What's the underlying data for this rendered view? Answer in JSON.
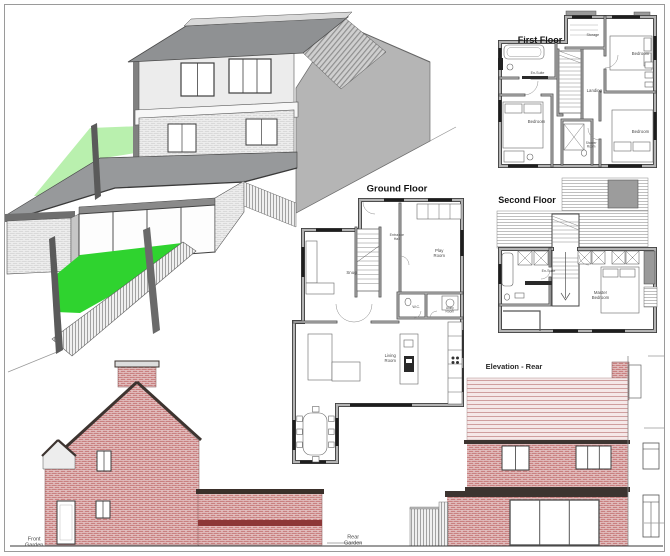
{
  "sheet": {
    "description_title": "House plans and elevations drawing sheet"
  },
  "labels": {
    "ff_title": "First Floor",
    "gf_title": "Ground Floor",
    "sf_title": "Second Floor",
    "rear_elev_title": "Elevation - Rear",
    "front_garden": "Front\nGarden",
    "rear_garden": "Rear\nGarden",
    "ff_storage": "Storage",
    "ff_bedroom_ne": "Bedroom",
    "ff_ensuite": "En-Suite",
    "ff_landing": "Landing",
    "ff_bedroom_sw": "Bedroom",
    "ff_bedroom_se": "Bedroom",
    "ff_shower_room": "Shower\nRoom",
    "gf_entrance_hall": "Entrance\nHall",
    "gf_play_room": "Play\nRoom",
    "gf_snug": "Snug",
    "gf_wc": "W.C.",
    "gf_utility_room": "Utility\nRoom",
    "gf_living_room": "Living\nRoom",
    "sf_ensuite": "En-Suite",
    "sf_master_bedroom": "Master\nBedroom"
  },
  "colors": {
    "page_background": "#ffffff",
    "frame_border": "#9a9a9a",
    "brick_red": "#c98080",
    "brick_mortar": "#e8cfcf",
    "brick_band_dark": "#8d3838",
    "roof_tile_pink": "#f5e8e8",
    "roof_tile_line": "#cf9f9f",
    "roof_fascia_dark": "#3d3430",
    "iso_roof_gray": "#8f9193",
    "iso_wall_light": "#ececec",
    "iso_neighbor_wall": "#b5b5b5",
    "grass_light": "#b9f0ae",
    "grass_bright": "#2fd32f",
    "plan_wall_gray": "#b3b3b3",
    "plan_wall_edge": "#3f3f3f",
    "fence_light": "#f0f0f0",
    "fence_stripe": "#8f8f8f"
  }
}
